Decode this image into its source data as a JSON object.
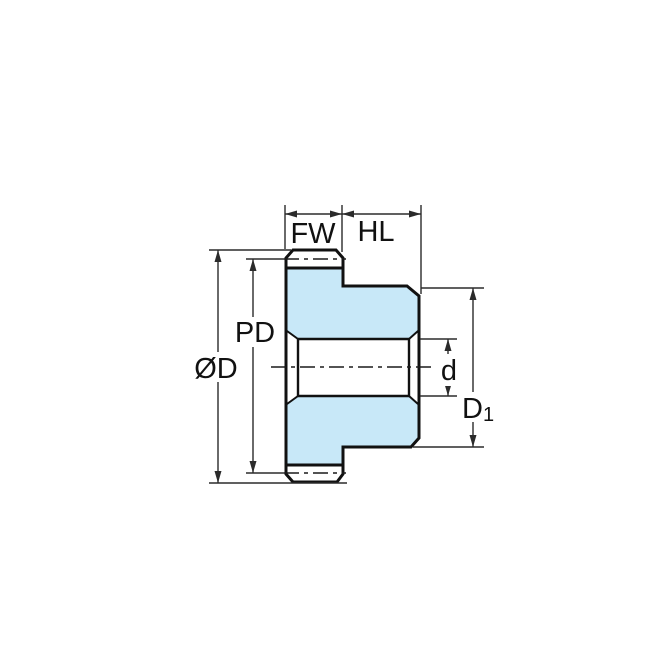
{
  "diagram": {
    "colors": {
      "background": "#ffffff",
      "part_fill": "#c8e8f8",
      "outline": "#111111",
      "dimension_lines": "#2b2b2b"
    },
    "labels": {
      "face_width": "FW",
      "hub_length": "HL",
      "pitch_diameter": "PD",
      "outside_diameter": "ØD",
      "bore_diameter": "d",
      "hub_diameter_main": "D",
      "hub_diameter_subscript": "1"
    }
  }
}
